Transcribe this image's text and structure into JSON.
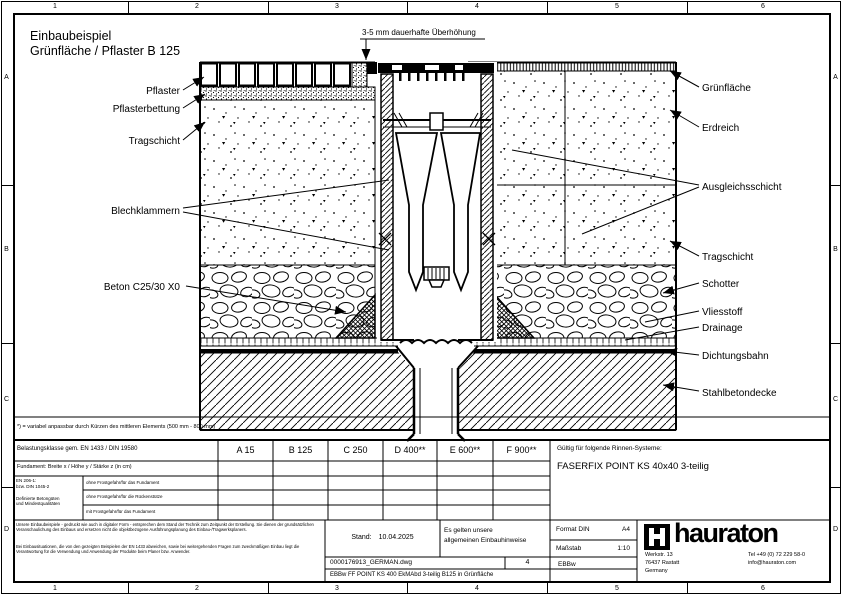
{
  "frame": {
    "columns": [
      "1",
      "2",
      "3",
      "4",
      "5",
      "6"
    ],
    "rows": [
      "A",
      "B",
      "C",
      "D"
    ]
  },
  "drawing": {
    "title_line1": "Einbaubeispiel",
    "title_line2": "Grünfläche / Pflaster B 125",
    "annotation": "3-5 mm dauerhafte Überhöhung",
    "labels_left": [
      {
        "text": "Pflaster"
      },
      {
        "text": "Pflasterbettung"
      },
      {
        "text": "Tragschicht"
      },
      {
        "text": "Blechklammern"
      },
      {
        "text": "Beton C25/30 X0"
      }
    ],
    "labels_right": [
      {
        "text": "Grünfläche"
      },
      {
        "text": "Erdreich"
      },
      {
        "text": "Ausgleichsschicht"
      },
      {
        "text": "Tragschicht"
      },
      {
        "text": "Schotter"
      },
      {
        "text": "Vliesstoff"
      },
      {
        "text": "Drainage"
      },
      {
        "text": "Dichtungsbahn"
      },
      {
        "text": "Stahlbetondecke"
      }
    ],
    "footnote": "*) = variabel anpassbar durch Kürzen des mittleren Elements (500 mm - 800 mm)"
  },
  "titleblock": {
    "load_class_label": "Belastungsklasse gem. EN 1433 / DIN 19580",
    "load_classes": [
      "A 15",
      "B 125",
      "C 250",
      "D 400**",
      "E 600**",
      "F 900**"
    ],
    "foundation_label": "Fundament: Breite x / Höhe y / Stärke z (in cm)",
    "concrete_norm": "EN 206-1:\nbzw. DIN 1045-2\n\nDefinierte Betongüten\nund Mindestqualitäten",
    "concrete_rows": [
      "ohne Frostgefahr/für das Fundament",
      "ohne Frostgefahr/für die Rückenstütze",
      "mit Frostgefahr/für das Fundament"
    ],
    "valid_for_label": "Gültig für folgende Rinnen-Systeme:",
    "system_name": "FASERFIX POINT KS 40x40 3-teilig",
    "disclaimer_1": "Unsere Einbaubeispiele - gedruckt wie auch in digitaler Form - entsprechen dem Stand der Technik zum Zeitpunkt der Erstellung. Sie dienen der grundsätzlichen Veranschaulichung des Einbaus und ersetzen nicht die objektbezogene Ausführungsplanung des Einbau-/Tragwerksplaners.",
    "disclaimer_2": "Bei Einbausituationen, die von den gezeigten Beispielen der EN 1433 abweichen, sowie bei weitergehenden Fragen zum zweckmäßigen Einbau liegt die Verantwortung für die Verwendung und Anwendung der Produkte beim Planer bzw. Anwender.",
    "stand_label": "Stand:",
    "stand_date": "10.04.2025",
    "hint": "Es gelten unsere\nallgemeinen Einbauhinweise",
    "format_label": "Format DIN",
    "format_value": "A4",
    "scale_label": "Maßstab",
    "scale_value": "1:10",
    "code": "EBBw",
    "file_name": "0000176913_GERMAN.dwg",
    "sheet": "4",
    "description": "EBBw FF POINT KS 400 EkMAbd 3-teilig B125 in Grünfläche"
  },
  "brand": {
    "name": "hauraton",
    "address": "Werkstr. 13\n76437 Rastatt\nGermany",
    "contact": "Tel +49 (0) 72 229 58-0\ninfo@hauraton.com"
  }
}
